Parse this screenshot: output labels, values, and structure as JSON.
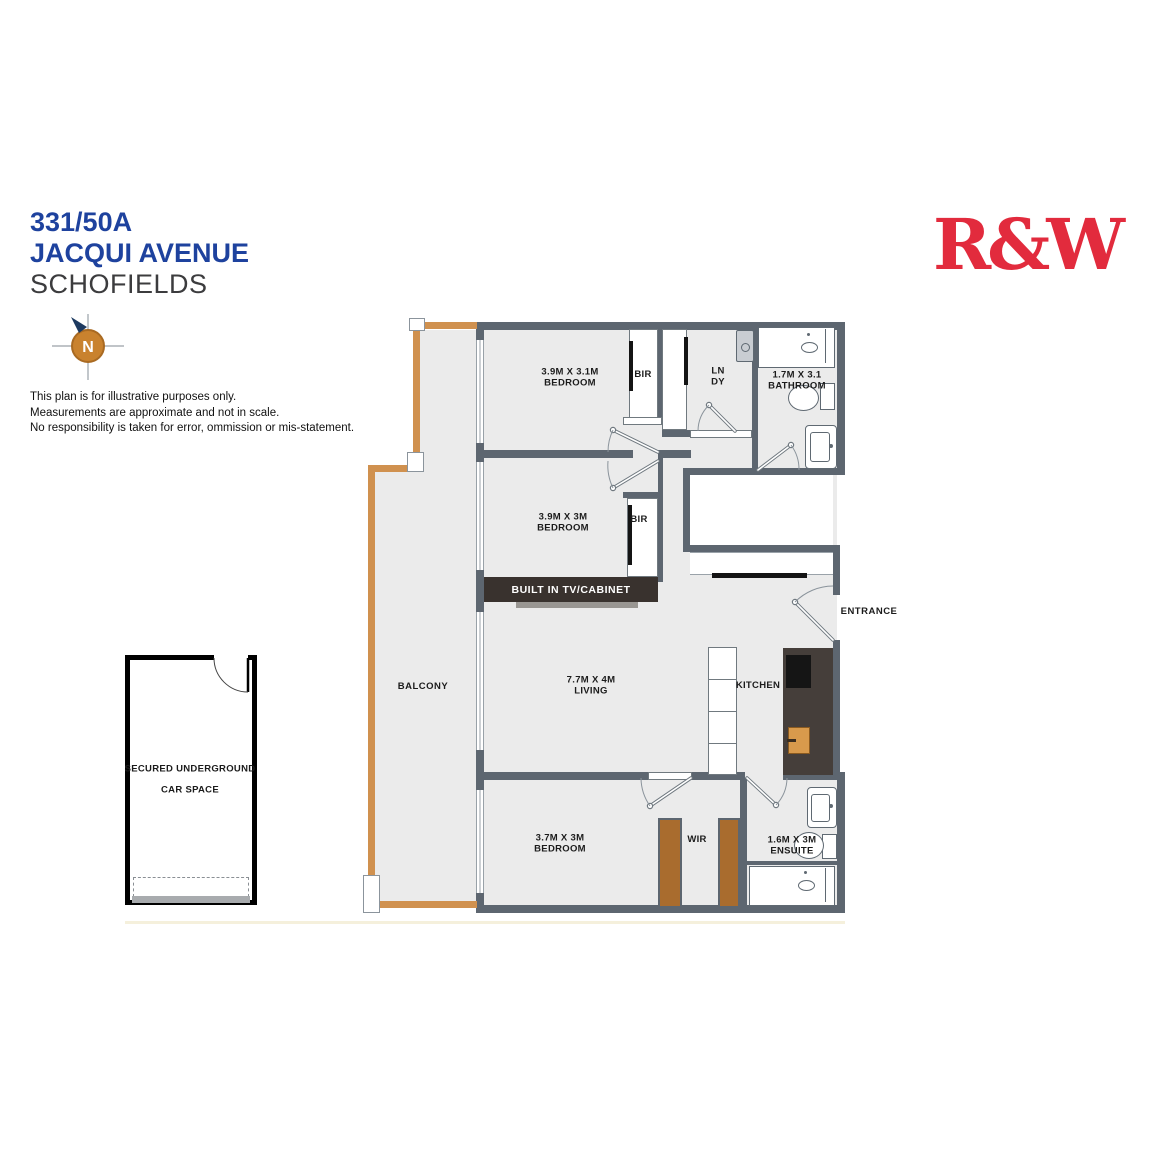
{
  "header": {
    "unit": "331/50A",
    "street": "JACQUI AVENUE",
    "suburb": "SCHOFIELDS",
    "logo": "R&W",
    "compass_n": "N",
    "disclaimer": [
      "This plan is for illustrative purposes only.",
      "Measurements are approximate and not in scale.",
      "No responsibility is taken for error, ommission or mis-statement."
    ]
  },
  "plan": {
    "rooms": {
      "bedroom1_dims": "3.9M X 3.1M",
      "bedroom1_name": "BEDROOM",
      "bir1": "BIR",
      "laundry_l1": "LN",
      "laundry_l2": "DY",
      "bathroom_dims": "1.7M X 3.1",
      "bathroom_name": "BATHROOM",
      "bedroom2_dims": "3.9M X 3M",
      "bedroom2_name": "BEDROOM",
      "bir2": "BIR",
      "tv_cabinet": "BUILT IN TV/CABINET",
      "living_dims": "7.7M X 4M",
      "living_name": "LIVING",
      "kitchen": "KITCHEN",
      "entrance": "ENTRANCE",
      "balcony": "BALCONY",
      "bedroom3_dims": "3.7M X 3M",
      "bedroom3_name": "BEDROOM",
      "wir": "WIR",
      "ensuite_dims": "1.6M X 3M",
      "ensuite_name": "ENSUITE",
      "carspace_l1": "SECURED UNDERGROUND",
      "carspace_l2": "CAR SPACE"
    },
    "colors": {
      "title_blue": "#1e429e",
      "logo_red": "#e22b3d",
      "wall_gray": "#5d6670",
      "room_fill": "#ebebeb",
      "balcony_rail": "#d0914f",
      "wardrobe_brown": "#a96c2e",
      "kitchen_counter": "#453e3a",
      "kitchen_sink": "#d89a4c",
      "compass_orange": "#c9822e"
    }
  }
}
